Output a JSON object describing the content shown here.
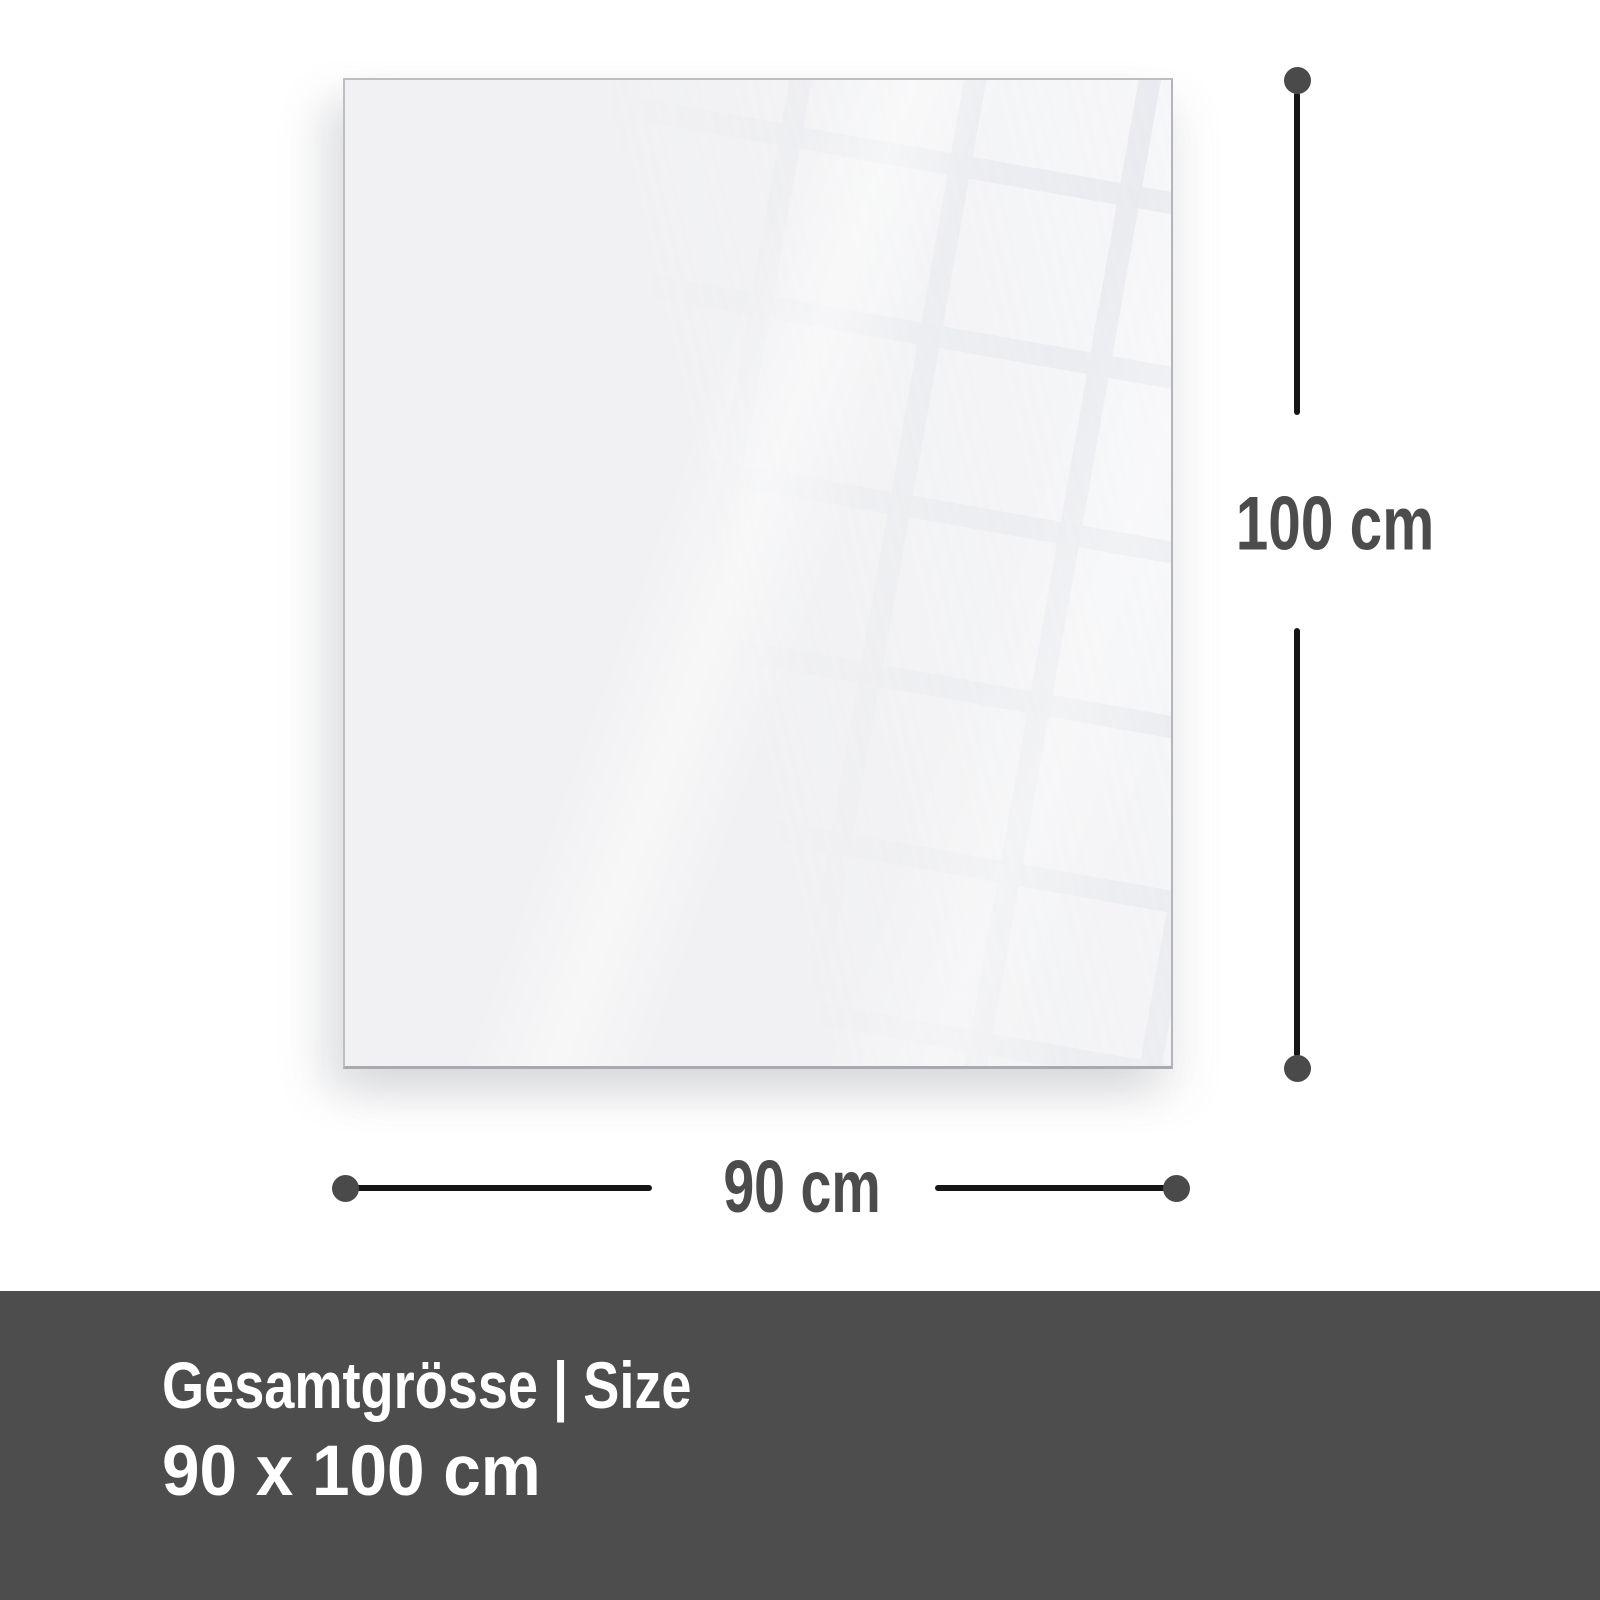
{
  "panel": {
    "description": "blank-glass-panel"
  },
  "dimensions": {
    "height": {
      "label": "100 cm"
    },
    "width": {
      "label": "90 cm"
    }
  },
  "banner": {
    "title": "Gesamtgrösse | Size",
    "size": "90 x 100 cm",
    "background": "#4d4d4d",
    "text_color": "#ffffff"
  },
  "colors": {
    "page_background": "#ffffff",
    "panel_background": "#f1f1f3",
    "panel_border": "#b3b5b8",
    "dimension_line": "#161616",
    "dimension_dot": "#4a4a4a",
    "dimension_text": "#4c4c4c"
  }
}
